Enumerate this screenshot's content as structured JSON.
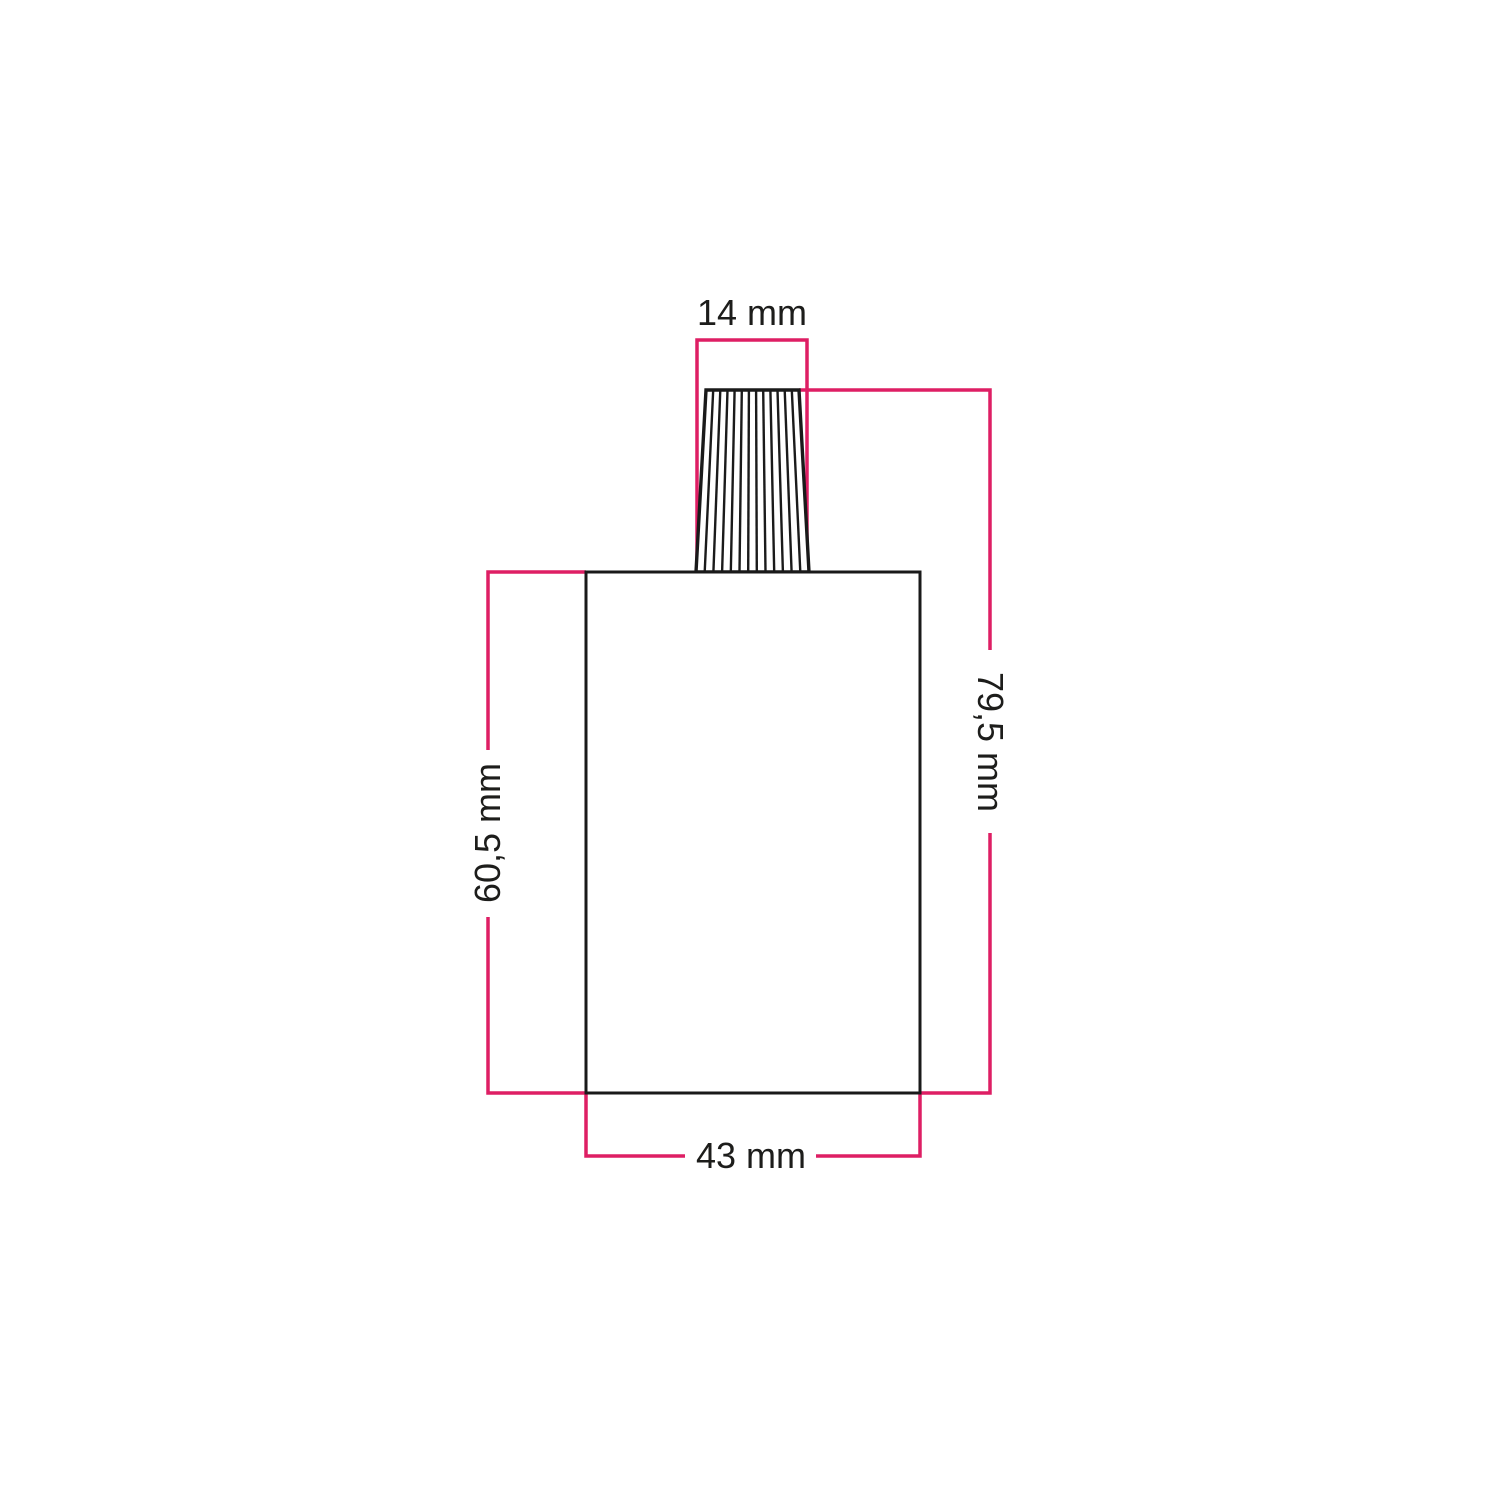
{
  "diagram": {
    "kind": "technical-dimension-drawing",
    "dimension_labels": {
      "top_width": "14 mm",
      "total_height": "79,5 mm",
      "body_height": "60,5 mm",
      "body_width": "43 mm"
    }
  },
  "colors": {
    "dimension_line": "#de1e64",
    "outline": "#1a1a1a",
    "text": "#1d1d1b",
    "background": "#ffffff"
  }
}
